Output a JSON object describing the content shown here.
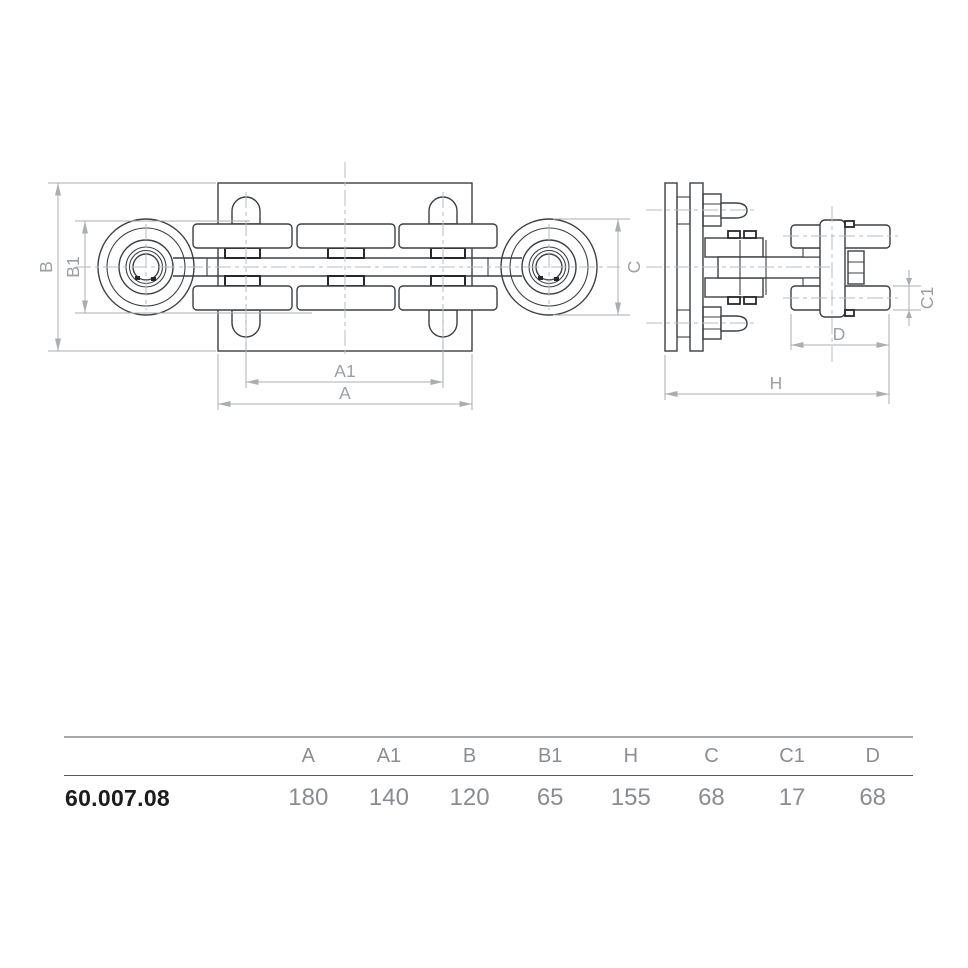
{
  "drawing": {
    "dim_labels": {
      "a": "A",
      "a1": "A1",
      "b": "B",
      "b1": "B1",
      "c": "C",
      "c1": "C1",
      "d": "D",
      "h": "H"
    }
  },
  "table": {
    "columns": [
      "A",
      "A1",
      "B",
      "B1",
      "H",
      "C",
      "C1",
      "D"
    ],
    "row": {
      "part": "60.007.08",
      "values": [
        "180",
        "140",
        "120",
        "65",
        "155",
        "68",
        "17",
        "68"
      ]
    }
  },
  "colors": {
    "line": "#3c4043",
    "accent_dark": "#26282b",
    "dim_line": "#a9aeb2",
    "dim_text": "#9ba0a4",
    "table_text": "#8b8f93",
    "part_text": "#1a1c1e",
    "rule_top": "#a5a8aa",
    "rule_mid": "#56595c"
  }
}
